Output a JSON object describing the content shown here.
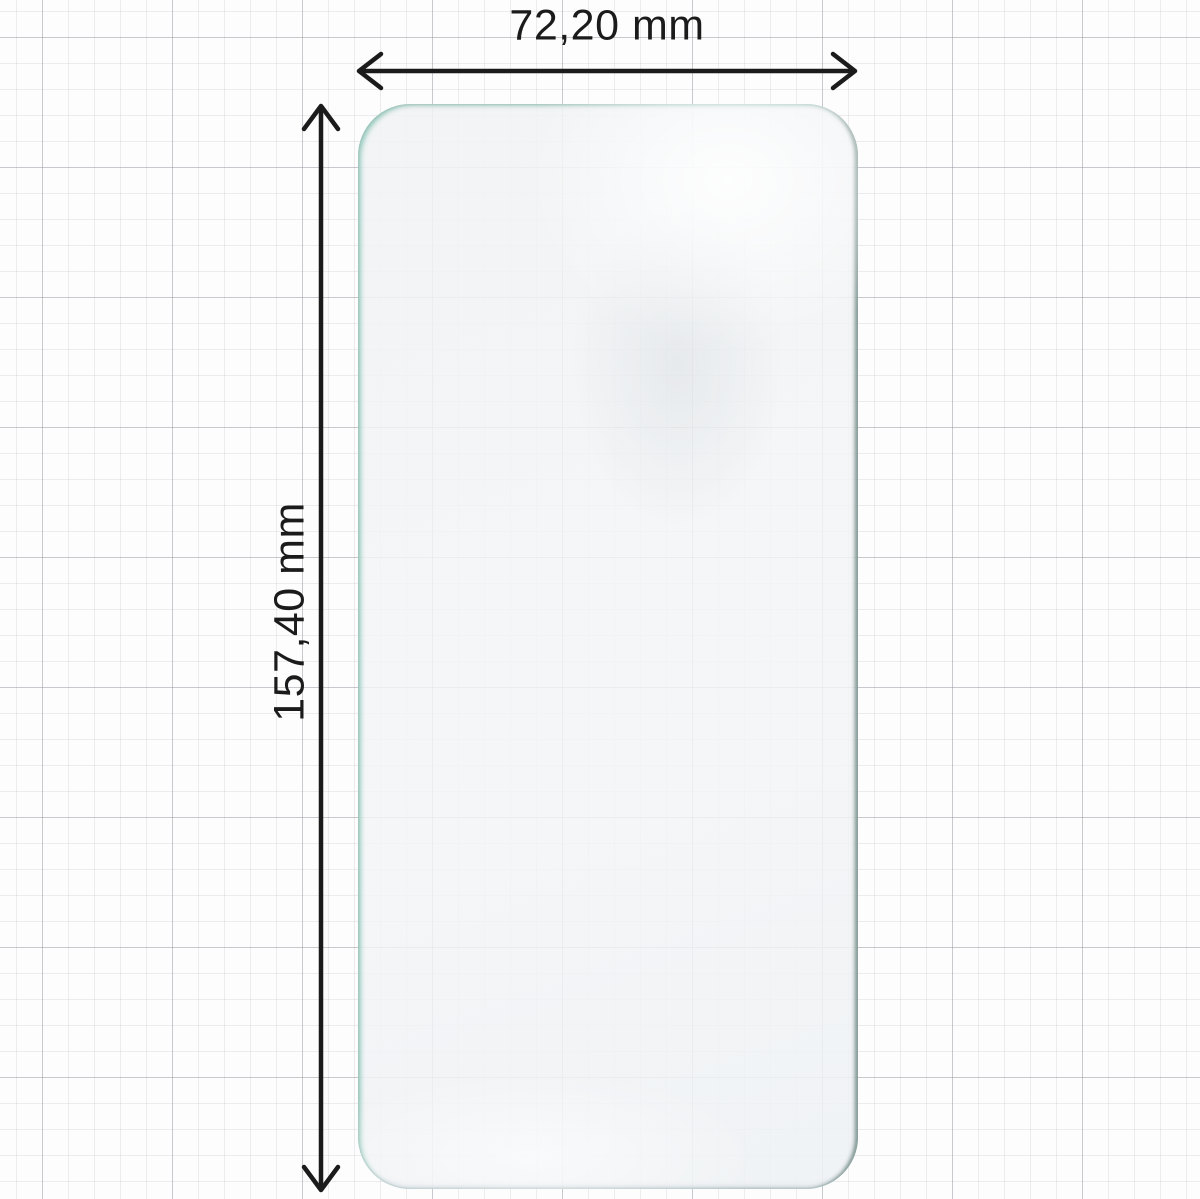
{
  "diagram": {
    "width_label": "72,20 mm",
    "height_label": "157,40 mm",
    "colors": {
      "arrow_and_text": "#1b1b1b",
      "background": "#fdfdfd",
      "grid_minor": "#e6e6ea",
      "grid_major": "#c2c2c8",
      "film_fill": "#f1f2f4",
      "film_edge_light_teal": "#cde5df",
      "film_edge_dark": "#879b97",
      "film_edge_bottom": "#c5ced6"
    }
  }
}
